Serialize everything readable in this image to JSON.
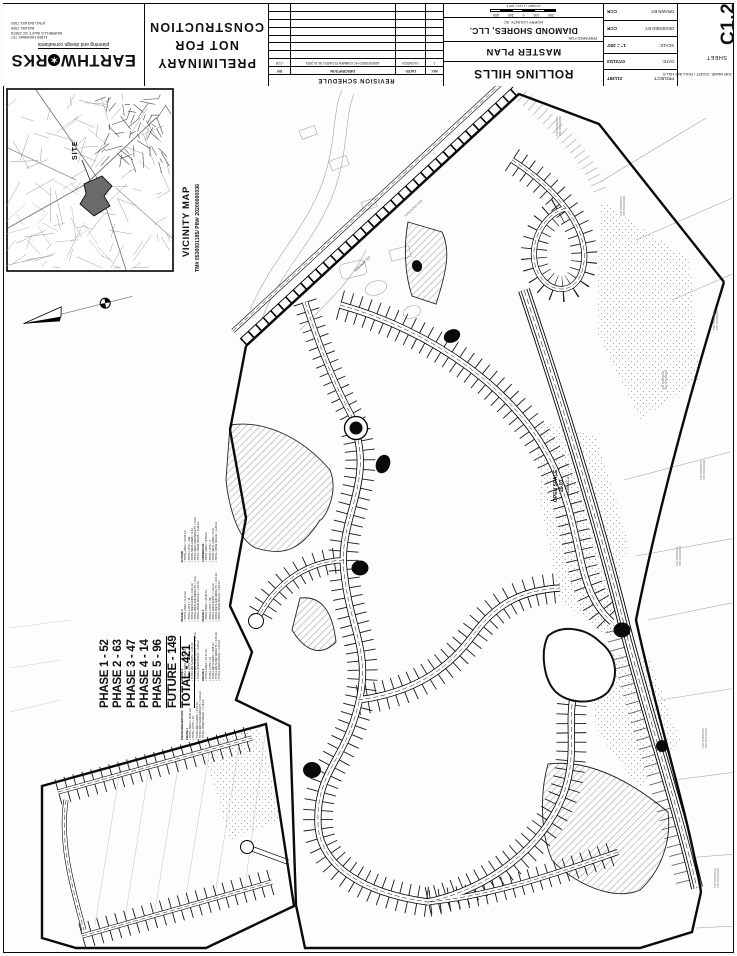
{
  "sheet_meta": {
    "sheet_word": "SHEET",
    "sheet_number": "C1.2",
    "project_label": "PROJECT:",
    "project_value": "21139T",
    "date_label": "DATE:",
    "date_value": "07/31/23",
    "scale_label": "SCALE:",
    "scale_value": "1\" = 200'",
    "designed_label": "DESIGNED BY:",
    "designed_value": "CCR",
    "drawn_label": "DRAWN BY:",
    "drawn_value": "CCR",
    "job_name": "JOB NAME: 21139T / ROLLING HILLS"
  },
  "titleblock": {
    "project_name": "ROLLING HILLS",
    "plan_type": "MASTER PLAN",
    "prepared_for": "PREPARED FOR:",
    "client": "DIAMOND SHORES, LLC.",
    "county": "HORRY COUNTY, SC",
    "scale_ticks": [
      "200",
      "100",
      "0",
      "200",
      "400"
    ],
    "scale_note": "( IN FEET )  1 inch = 200 ft."
  },
  "revision_schedule": {
    "title": "REVISION SCHEDULE",
    "columns": [
      "NO.",
      "DATE:",
      "DESCRIPTION",
      "BY"
    ],
    "rows": [
      [
        "1",
        "01/29/2024",
        "ADDRESSED HC COMMENTS DATED 09-19-2023",
        "CCR"
      ]
    ]
  },
  "stamp": {
    "line1": "PRELIMINARY",
    "line2": "NOT FOR",
    "line3": "CONSTRUCTION"
  },
  "firm": {
    "name_left": "EARTHW",
    "name_right": "RKS",
    "globe_char": "✶",
    "tagline": "planning and design consultants",
    "address_lines": [
      "11855 HIGHWAY 707",
      "MURRELLS INLET, SC 29576",
      "843.651.7900",
      "(FAX) 843.651.7902"
    ]
  },
  "vicinity": {
    "title": "VICINITY MAP",
    "parcel_line": "TM# 0530001185/ PIN# 20200000036",
    "site_label": "SITE"
  },
  "phase_summary": {
    "lines": [
      "PHASE 1 - 52",
      "PHASE 2 - 63",
      "PHASE 3 - 47",
      "PHASE 4 - 14",
      "PHASE 5 - 96",
      "FUTURE - 149",
      "TOTAL  -  421"
    ]
  },
  "phase_breakdown": {
    "heading": "PHASE BREAKDOWN:",
    "sections": [
      {
        "title": "PHASE 1",
        "items": [
          "TOTAL AREA = 16.51 AC",
          "TOTAL LOTS = 52",
          "TOTAL WETLANDS = 0.12 AC",
          "TOTAL WETLAND IMPACTS = 0.10 AC",
          "TOTAL OPEN SPACE = 2.16 AC"
        ]
      },
      {
        "title": "PHASE 2",
        "items": [
          "TOTAL AREA = 18.94 AC",
          "TOTAL LOTS = 63",
          "TOTAL WETLANDS = 0.45 AC",
          "TOTAL WETLAND IMPACTS = 0.12 AC",
          "TOTAL OPEN SPACE = 3.08 AC"
        ]
      },
      {
        "title": "PHASE 3",
        "items": [
          "TOTAL AREA = 15.27 AC",
          "TOTAL LOTS = 47",
          "TOTAL WETLANDS = 0.88 AC",
          "TOTAL WETLAND IMPACTS = 0.15 AC",
          "TOTAL OPEN SPACE = 2.44 AC"
        ]
      },
      {
        "title": "PHASE 4",
        "items": [
          "TOTAL AREA = 6.12 AC",
          "TOTAL LOTS = 14",
          "TOTAL WETLANDS = 0.31 AC",
          "TOTAL WETLAND IMPACTS = 0 AC",
          "TOTAL OPEN SPACE = 1.10 AC"
        ]
      },
      {
        "title": "PHASE 5",
        "items": [
          "TOTAL AREA = 24.60 AC",
          "TOTAL LOTS = 96",
          "TOTAL WETLANDS = 1.24 AC",
          "TOTAL WETLAND IMPACTS = 0.21 AC",
          "TOTAL OPEN SPACE = 4.62 AC"
        ]
      },
      {
        "title": "FUTURE",
        "items": [
          "TOTAL AREA = 53.04 AC",
          "TOTAL LOTS = 149",
          "TOTAL WETLANDS = 0 AC",
          "TOTAL WETLAND IMPACTS = 0 AC",
          "TOTAL OPEN SPACE = 9.38 AC"
        ]
      },
      {
        "title": "COMMERCIAL",
        "items": [
          "TOTAL AREA = 8.55 AC",
          "TOTAL LOTS = 2",
          "TOTAL WETLANDS = 0 AC",
          "TOTAL OPEN SPACE = 1.20 AC"
        ]
      }
    ]
  },
  "plan_labels": {
    "open_space": "OPEN SPACE",
    "open_space_no": "20.03",
    "open_space_area": "18.68 AC ±",
    "highway": "HIGHWAY 707",
    "railroad": "RAILROAD R/W",
    "adjacent_tm": "TM# 0530000000",
    "adjacent_pin": "PIN# 0000000000"
  },
  "colors": {
    "ink": "#111111",
    "gray_existing": "#9a9a9a",
    "paper": "#fdfdfc"
  }
}
